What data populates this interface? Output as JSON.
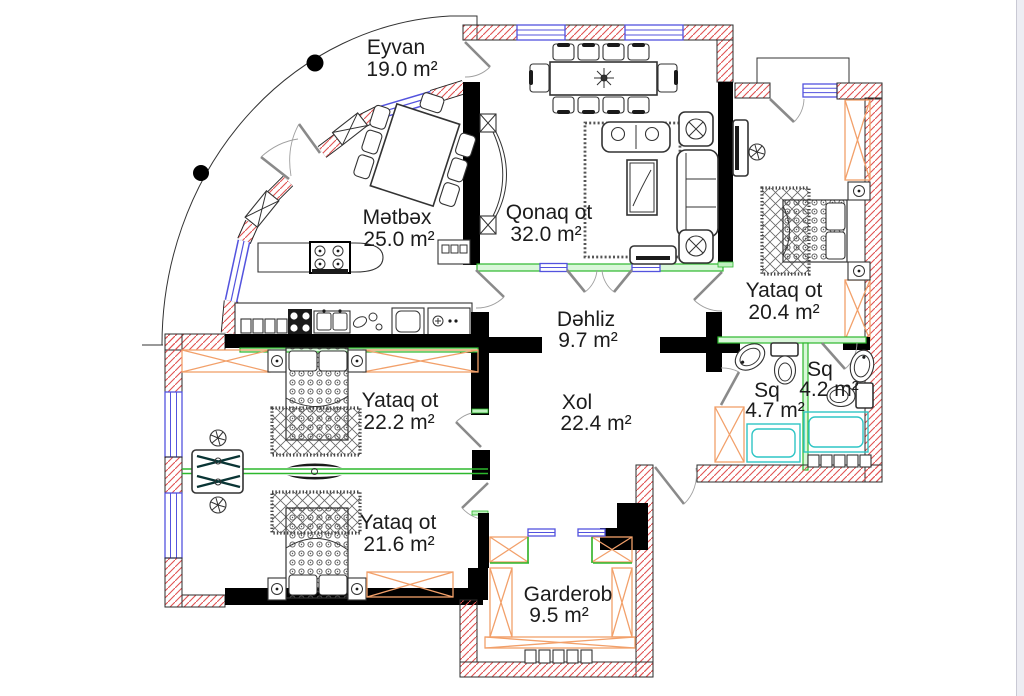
{
  "plan": {
    "title": "apartment-floor-plan",
    "rooms": [
      {
        "id": "eyvan",
        "name": "Eyvan",
        "area": "19.0 m²"
      },
      {
        "id": "metbex",
        "name": "Mətbəx",
        "area": "25.0 m²"
      },
      {
        "id": "qonaq-ot",
        "name": "Qonaq ot",
        "area": "32.0 m²"
      },
      {
        "id": "yataq-right",
        "name": "Yataq ot",
        "area": "20.4 m²"
      },
      {
        "id": "dehliz",
        "name": "Dəhliz",
        "area": "9.7 m²"
      },
      {
        "id": "xol",
        "name": "Xol",
        "area": "22.4 m²"
      },
      {
        "id": "sq-left",
        "name": "Sq",
        "area": "4.7 m²"
      },
      {
        "id": "sq-right",
        "name": "Sq",
        "area": "4.2 m²"
      },
      {
        "id": "yataq-middle",
        "name": "Yataq ot",
        "area": "22.2 m²"
      },
      {
        "id": "yataq-bottom",
        "name": "Yataq ot",
        "area": "21.6 m²"
      },
      {
        "id": "garderob",
        "name": "Garderob",
        "area": "9.5 m²"
      }
    ],
    "colors": {
      "walls": "#000000",
      "hatch": "#e05252",
      "window": "#5353de",
      "partition": "#2db82d",
      "furniture": "#f2a06a",
      "fixtures": "#2fc5c5"
    }
  }
}
